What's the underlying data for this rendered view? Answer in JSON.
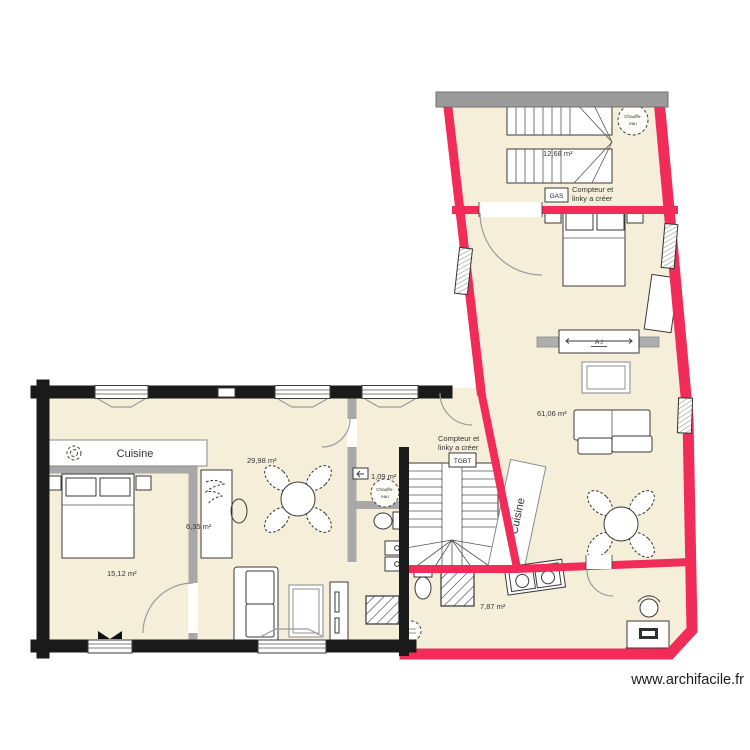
{
  "watermark": "www.archifacile.fr",
  "colors": {
    "exterior_left_wall": "#1a1a1a",
    "exterior_right_wall": "#f22c58",
    "interior_wall": "#a8a8a8",
    "top_wall": "#9b9b9b",
    "floor": "#f5efda"
  },
  "areas": {
    "stair_room": "12,68 m²",
    "main_room": "61,06 m²",
    "living_room": "29,98 m²",
    "bedroom": "15,12 m²",
    "closet": "6,35 m²",
    "wc": "1,09 m²",
    "bathroom": "7,87 m²"
  },
  "labels": {
    "kitchen_left": "Cuisine",
    "kitchen_right": "Cuisine",
    "sliding_door": "A.I"
  },
  "notes": {
    "meter_line1": "Compteur et",
    "meter_line2": "linky a créer",
    "gas_box": "GAS",
    "tgbt_box": "TGBT",
    "heater_line1": "Chauffe-",
    "heater_line2": "eau"
  }
}
